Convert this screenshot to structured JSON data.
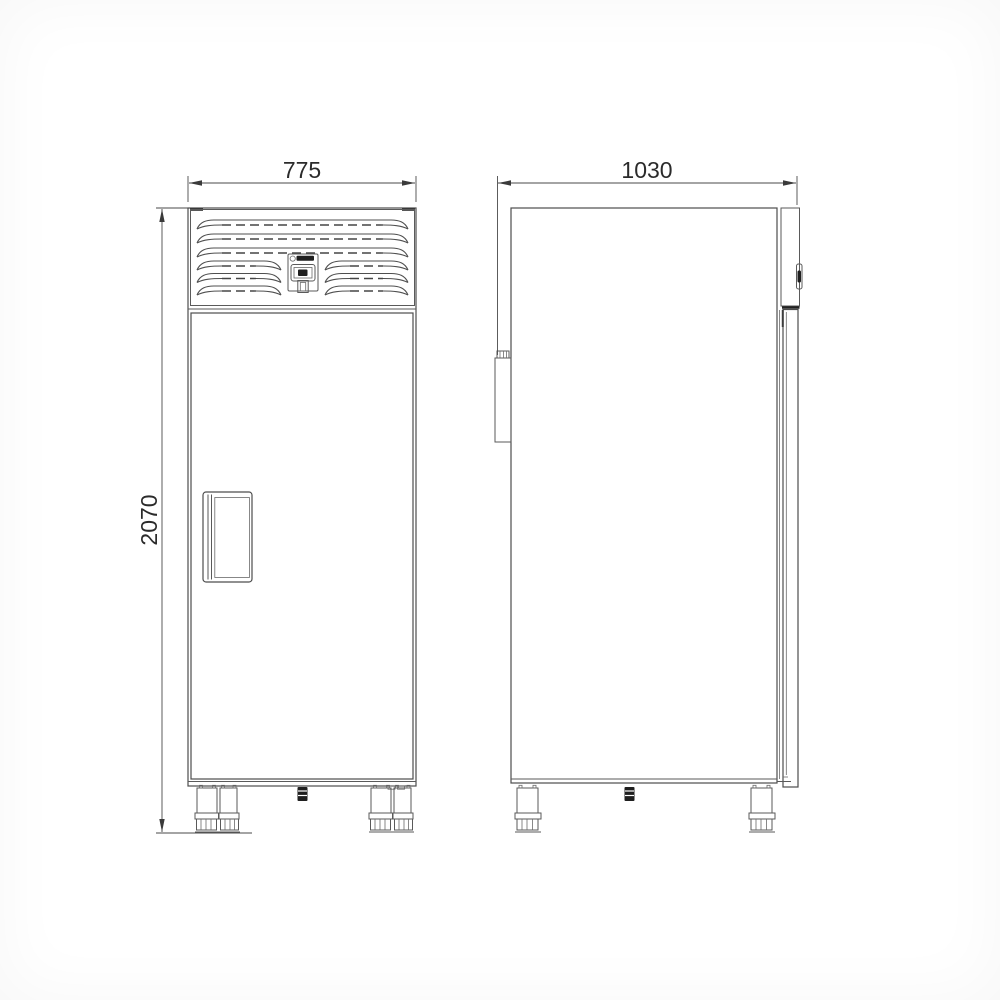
{
  "meta": {
    "description": "Technical dimension drawing of an upright commercial refrigerator shown in front view and side view"
  },
  "colors": {
    "background": "#ffffff",
    "line": "#4d4d4d",
    "dark_detail": "#1f1f1f",
    "dimension_text": "#2b2b2b"
  },
  "dimensions": {
    "front_width": "775",
    "side_depth": "1030",
    "height": "2070"
  },
  "views": {
    "front": {
      "parts": [
        "ventilation-grille",
        "control-panel",
        "door",
        "door-handle",
        "adjustable-feet",
        "drain-outlet"
      ]
    },
    "side": {
      "parts": [
        "cabinet-body",
        "door-edge",
        "top-hinge",
        "wall-spacer",
        "adjustable-feet",
        "drain-outlet"
      ]
    }
  }
}
